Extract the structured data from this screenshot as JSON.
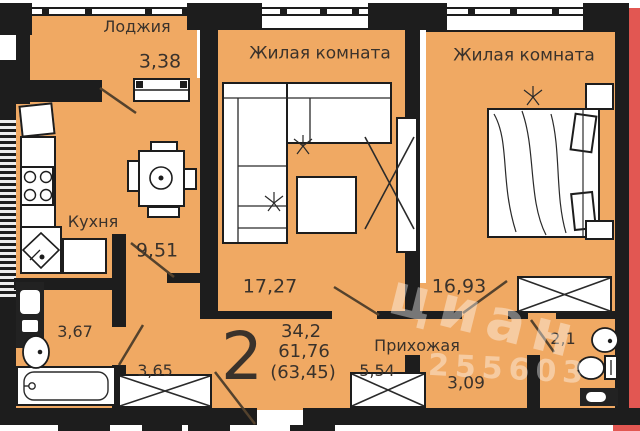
{
  "plan": {
    "rooms": {
      "loggia": {
        "name": "Лоджия",
        "area": "3,38"
      },
      "kitchen": {
        "name": "Кухня",
        "area": "9,51"
      },
      "living_room_1": {
        "name": "Жилая комната",
        "area": "17,27"
      },
      "living_room_2": {
        "name": "Жилая комната",
        "area": "16,93"
      },
      "hallway": {
        "name": "Прихожая",
        "area": "5,54"
      },
      "bathroom": {
        "area": "3,67"
      },
      "hall": {
        "area": "3,65"
      },
      "corridor": {
        "area": "3,09"
      },
      "wc": {
        "area": "2,1"
      }
    },
    "summary": {
      "rooms_count": "2",
      "living_area": "34,2",
      "apartment_area": "61,76",
      "total_area": "(63,45)"
    },
    "watermark": {
      "brand": "циан",
      "listing_id": "255603"
    },
    "colors": {
      "floor": "#F0A963",
      "wall": "#1D1D1D",
      "neighbor": "#E25752",
      "text": "#3A322B"
    }
  }
}
